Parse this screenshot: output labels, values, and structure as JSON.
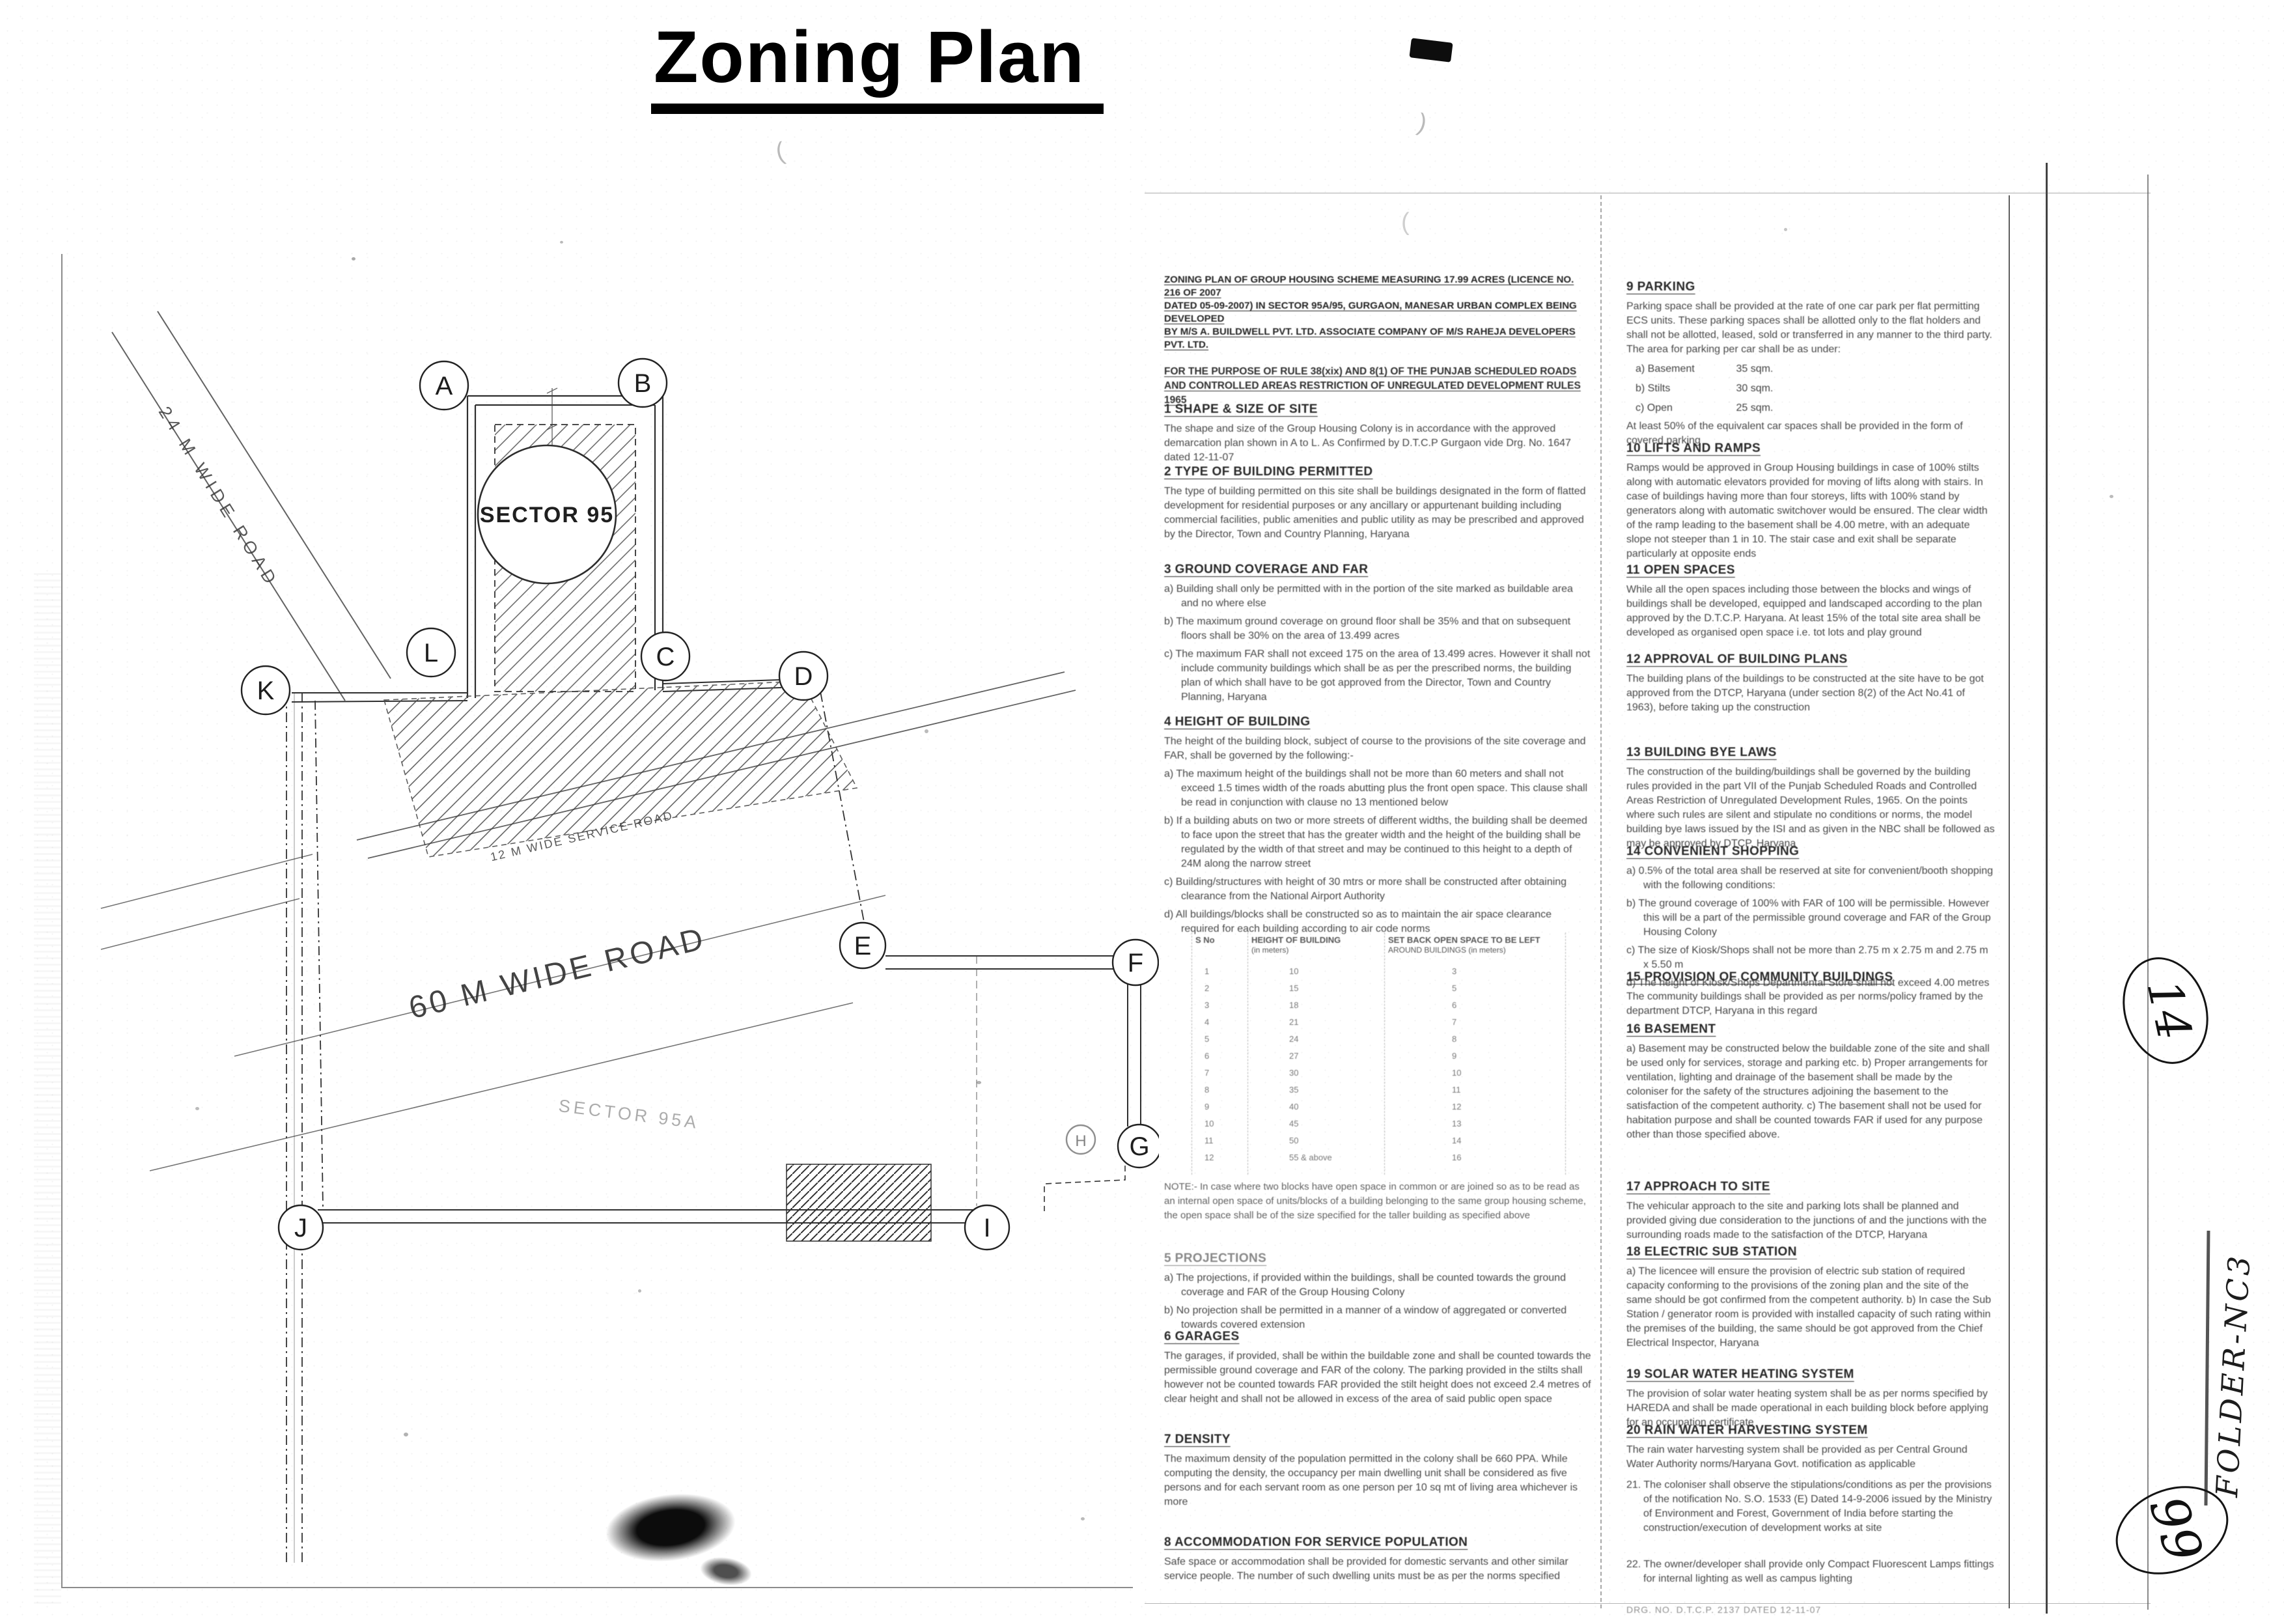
{
  "title": "Zoning Plan",
  "plan": {
    "letters": [
      "A",
      "B",
      "L",
      "C",
      "K",
      "D",
      "E",
      "F",
      "G",
      "H",
      "I",
      "J"
    ],
    "sector_circle": "SECTOR 95",
    "sector_faint": "SECTOR 95A",
    "roads": {
      "r24": "24 M WIDE ROAD",
      "r12": "12 M WIDE SERVICE ROAD",
      "r60": "60 M WIDE ROAD"
    }
  },
  "mid": {
    "header": {
      "l1": "ZONING PLAN OF GROUP HOUSING SCHEME MEASURING 17.99 ACRES (LICENCE NO. 216 OF 2007",
      "l2": "DATED 05-09-2007) IN SECTOR 95A/95, GURGAON, MANESAR URBAN COMPLEX BEING DEVELOPED",
      "l3": "BY M/S A. BUILDWELL PVT. LTD. ASSOCIATE COMPANY OF M/S RAHEJA DEVELOPERS PVT. LTD."
    },
    "purpose": {
      "l1": "FOR THE PURPOSE OF RULE 38(xix) AND 8(1) OF THE PUNJAB SCHEDULED ROADS",
      "l2": "AND CONTROLLED AREAS RESTRICTION OF UNREGULATED DEVELOPMENT RULES 1965"
    },
    "s1": {
      "h": "1 SHAPE & SIZE OF SITE",
      "body": "The shape and size of the Group Housing Colony is in accordance with the approved demarcation plan shown in A to L. As Confirmed by D.T.C.P Gurgaon vide Drg. No. 1647 dated 12-11-07"
    },
    "s2": {
      "h": "2 TYPE OF BUILDING PERMITTED",
      "body": "The type of building permitted on this site shall be buildings designated in the form of flatted development for residential purposes or any ancillary or appurtenant building including commercial facilities, public amenities and public utility as may be prescribed and approved by the Director, Town and Country Planning, Haryana"
    },
    "s3": {
      "h": "3 GROUND COVERAGE AND FAR",
      "a": "a) Building shall only be permitted with in the portion of the site marked as buildable area and no where else",
      "b": "b) The maximum ground coverage on ground floor shall be 35% and that on subsequent floors shall be 30% on the area of 13.499 acres",
      "c": "c) The maximum FAR shall not exceed 175 on the area of 13.499 acres. However it shall not include community buildings which shall be as per the prescribed norms, the building plan of which shall have to be got approved from the Director, Town and Country Planning, Haryana"
    },
    "s4": {
      "h": "4 HEIGHT OF BUILDING",
      "intro": "The height of the building block, subject of course to the provisions of the site coverage and FAR, shall be governed by the following:-",
      "a": "a) The maximum height of the buildings shall not be more than 60 meters and shall not exceed 1.5 times width of the roads abutting plus the front open space. This clause shall be read in conjunction with clause no 13 mentioned below",
      "b": "b) If a building abuts on two or more streets of different widths, the building shall be deemed to face upon the street that has the greater width and the height of the building shall be regulated by the width of that street and may be continued to this height to a depth of 24M along the narrow street",
      "c": "c) Building/structures with height of 30 mtrs or more shall be constructed after obtaining clearance from the National Airport Authority",
      "d": "d) All buildings/blocks shall be constructed so as to maintain the air space clearance required for each building according to air code norms"
    },
    "table": {
      "h1": "S No",
      "h2": "HEIGHT OF BUILDING",
      "h2b": "(in meters)",
      "h3": "SET BACK OPEN SPACE TO BE LEFT",
      "h3b": "AROUND BUILDINGS (in meters)",
      "rows": [
        {
          "n": "1",
          "ht": "10",
          "s": "3"
        },
        {
          "n": "2",
          "ht": "15",
          "s": "5"
        },
        {
          "n": "3",
          "ht": "18",
          "s": "6"
        },
        {
          "n": "4",
          "ht": "21",
          "s": "7"
        },
        {
          "n": "5",
          "ht": "24",
          "s": "8"
        },
        {
          "n": "6",
          "ht": "27",
          "s": "9"
        },
        {
          "n": "7",
          "ht": "30",
          "s": "10"
        },
        {
          "n": "8",
          "ht": "35",
          "s": "11"
        },
        {
          "n": "9",
          "ht": "40",
          "s": "12"
        },
        {
          "n": "10",
          "ht": "45",
          "s": "13"
        },
        {
          "n": "11",
          "ht": "50",
          "s": "14"
        },
        {
          "n": "12",
          "ht": "55 & above",
          "s": "16"
        }
      ]
    },
    "note": "NOTE:- In case where two blocks have open space in common or are joined so as to be read as an internal open space of units/blocks of a building belonging to the same group housing scheme, the open space shall be of the size specified for the taller building as specified above",
    "s5": {
      "h": "5 PROJECTIONS",
      "a": "a) The projections, if provided within the buildings, shall be counted towards the ground coverage and FAR of the Group Housing Colony",
      "b": "b) No projection shall be permitted in a manner of a window of aggregated or converted towards covered extension"
    },
    "s6": {
      "h": "6 GARAGES",
      "body": "The garages, if provided, shall be within the buildable zone and shall be counted towards the permissible ground coverage and FAR of the colony. The parking provided in the stilts shall however not be counted towards FAR provided the stilt height does not exceed 2.4 metres of clear height and shall not be allowed in excess of the area of said public open space"
    },
    "s7": {
      "h": "7 DENSITY",
      "body": "The maximum density of the population permitted in the colony shall be 660 PPA. While computing the density, the occupancy per main dwelling unit shall be considered as five persons and for each servant room as one person per 10 sq mt of living area whichever is more"
    },
    "s8": {
      "h": "8 ACCOMMODATION FOR SERVICE POPULATION",
      "body": "Safe space or accommodation shall be provided for domestic servants and other similar service people. The number of such dwelling units must be as per the norms specified"
    }
  },
  "right": {
    "s9": {
      "h": "9 PARKING",
      "body": "Parking space shall be provided at the rate of one car park per flat permitting ECS units. These parking spaces shall be allotted only to the flat holders and shall not be allotted, leased, sold or transferred in any manner to the third party. The area for parking per car shall be as under:",
      "items": [
        {
          "label": "a)  Basement",
          "value": "35 sqm."
        },
        {
          "label": "b)  Stilts",
          "value": "30 sqm."
        },
        {
          "label": "c)  Open",
          "value": "25 sqm."
        }
      ],
      "tail": "At least 50% of the equivalent car spaces shall be provided in the form of covered parking"
    },
    "s10": {
      "h": "10 LIFTS AND RAMPS",
      "body": "Ramps would be approved in Group Housing buildings in case of 100% stilts along with automatic elevators provided for moving of lifts along with stairs. In case of buildings having more than four storeys, lifts with 100% stand by generators along with automatic switchover would be ensured. The clear width of the ramp leading to the basement shall be 4.00 metre, with an adequate slope not steeper than 1 in 10. The stair case and exit shall be separate particularly at opposite ends"
    },
    "s11": {
      "h": "11 OPEN SPACES",
      "body": "While all the open spaces including those between the blocks and wings of buildings shall be developed, equipped and landscaped according to the plan approved by the D.T.C.P. Haryana. At least 15% of the total site area shall be developed as organised open space i.e. tot lots and play ground"
    },
    "s12": {
      "h": "12 APPROVAL OF BUILDING PLANS",
      "body": "The building plans of the buildings to be constructed at the site have to be got approved from the DTCP, Haryana (under section 8(2) of the Act No.41 of 1963), before taking up the construction"
    },
    "s13": {
      "h": "13 BUILDING BYE LAWS",
      "body": "The construction of the building/buildings shall be governed by the building rules provided in the part VII of the Punjab Scheduled Roads and Controlled Areas Restriction of Unregulated Development Rules, 1965. On the points where such rules are silent and stipulate no conditions or norms, the model building bye laws issued by the ISI and as given in the NBC shall be followed as may be approved by DTCP, Haryana"
    },
    "s14": {
      "h": "14 CONVENIENT SHOPPING",
      "a": "a) 0.5% of the total area shall be reserved at site for convenient/booth shopping with the following conditions:",
      "b": "b) The ground coverage of 100% with FAR of 100 will be permissible. However this will be a part of the permissible ground coverage and FAR of the Group Housing Colony",
      "c": "c) The size of Kiosk/Shops shall not be more than 2.75 m x 2.75 m and 2.75 m x 5.50 m",
      "d": "d) The height of Kiosk/Shops Departmental Store shall not exceed 4.00 metres"
    },
    "s15": {
      "h": "15 PROVISION OF COMMUNITY BUILDINGS",
      "body": "The community buildings shall be provided as per norms/policy framed by the department DTCP, Haryana in this regard"
    },
    "s16": {
      "h": "16 BASEMENT",
      "body": "a) Basement may be constructed below the buildable zone of the site and shall be used only for services, storage and parking etc. b) Proper arrangements for ventilation, lighting and drainage of the basement shall be made by the coloniser for the safety of the structures adjoining the basement to the satisfaction of the competent authority. c) The basement shall not be used for habitation purpose and shall be counted towards FAR if used for any purpose other than those specified above."
    },
    "s17": {
      "h": "17 APPROACH TO SITE",
      "body": "The vehicular approach to the site and parking lots shall be planned and provided giving due consideration to the junctions of and the junctions with the surrounding roads made to the satisfaction of the DTCP, Haryana"
    },
    "s18": {
      "h": "18 ELECTRIC SUB STATION",
      "body": "a) The licencee will ensure the provision of electric sub station of required capacity conforming to the provisions of the zoning plan and the site of the same should be got confirmed from the competent authority. b) In case the Sub Station / generator room is provided with installed capacity of such rating within the premises of the building, the same should be got approved from the Chief Electrical Inspector, Haryana"
    },
    "s19": {
      "h": "19 SOLAR WATER HEATING SYSTEM",
      "body": "The provision of solar water heating system shall be as per norms specified by HAREDA and shall be made operational in each building block before applying for an occupation certificate"
    },
    "s20": {
      "h": "20 RAIN WATER HARVESTING SYSTEM",
      "body": "The rain water harvesting system shall be provided as per Central Ground Water Authority norms/Haryana Govt. notification as applicable"
    },
    "s21": "21.  The coloniser shall observe the stipulations/conditions as per the provisions of the notification No. S.O. 1533 (E) Dated 14-9-2006 issued by the Ministry of Environment and Forest, Government of India before starting the construction/execution of development works at site",
    "s22": "22.  The owner/developer shall provide only Compact Fluorescent Lamps fittings for internal lighting as well as campus lighting",
    "drg": "DRG. NO. D.T.C.P. 2137 DATED 12-11-07"
  },
  "handwriting": {
    "page_number": "14",
    "folder": "FOLDER-NC3",
    "alt_number": "99"
  }
}
